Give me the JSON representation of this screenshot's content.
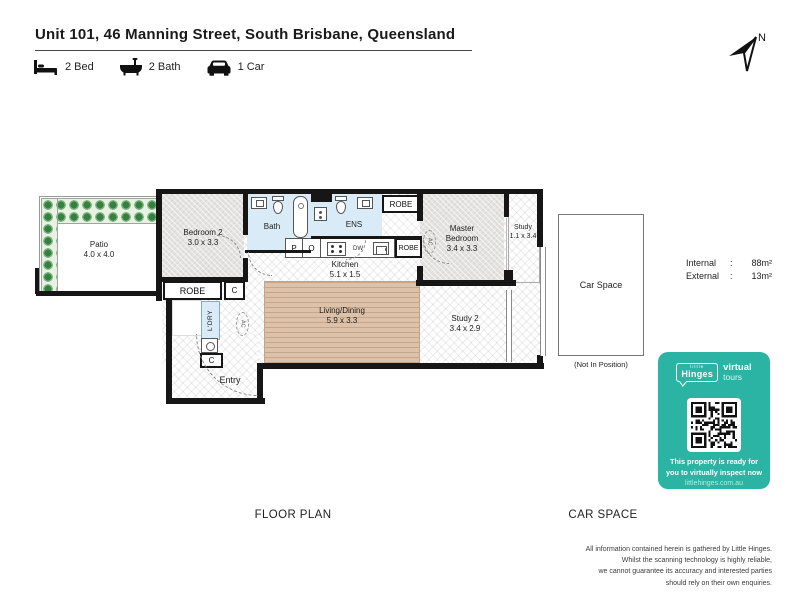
{
  "header": {
    "title": "Unit 101, 46 Manning Street, South Brisbane, Queensland",
    "features": [
      {
        "icon": "bed-icon",
        "label": "2 Bed"
      },
      {
        "icon": "bath-icon",
        "label": "2 Bath"
      },
      {
        "icon": "car-icon",
        "label": "1 Car"
      }
    ],
    "compass": "N"
  },
  "plan": {
    "patio": {
      "name": "Patio",
      "dims": "4.0 x 4.0"
    },
    "bedroom2": {
      "name": "Bedroom 2",
      "dims": "3.0 x 3.3"
    },
    "bath": {
      "name": "Bath"
    },
    "ens": {
      "name": "ENS"
    },
    "master": {
      "line1": "Master",
      "line2": "Bedroom",
      "dims": "3.4 x 3.3"
    },
    "study": {
      "name": "Study",
      "dims": "1.1 x 3.4"
    },
    "kitchen": {
      "name": "Kitchen",
      "dims": "5.1 x 1.5"
    },
    "living": {
      "name": "Living/Dining",
      "dims": "5.9 x 3.3"
    },
    "study2": {
      "name": "Study 2",
      "dims": "3.4 x 2.9"
    },
    "entry": {
      "name": "Entry"
    },
    "robe_top": "ROBE",
    "robe_kitchen": "ROBE",
    "robe_bed2": "ROBE",
    "closet1": "C",
    "closet2": "C",
    "laundry": "L'DRY",
    "p_label": "P",
    "o_label": "O",
    "dw_label": "DW",
    "ac1": "AC",
    "ac2": "AC"
  },
  "areas": {
    "internal_label": "Internal",
    "internal_sep": ":",
    "internal_value": "88m²",
    "external_label": "External",
    "external_sep": ":",
    "external_value": "13m²"
  },
  "car_space": {
    "label": "Car Space",
    "note": "(Not In Position)"
  },
  "section_labels": {
    "floor_plan": "FLOOR PLAN",
    "car_space": "CAR SPACE"
  },
  "badge": {
    "color": "#2bb3a3",
    "brand_top": "little",
    "brand": "Hinges",
    "product_line1": "virtual",
    "product_line2": "tours",
    "cta_line1": "This property is ready for",
    "cta_line2": "you to virtually inspect now",
    "url": "littlehinges.com.au"
  },
  "disclaimer": {
    "line1": "All information contained herein is gathered by Little Hinges.",
    "line2": "Whilst the scanning technology is highly reliable,",
    "line3": "we cannot guarantee its accuracy and interested parties",
    "line4": "should rely on their own enquiries."
  }
}
